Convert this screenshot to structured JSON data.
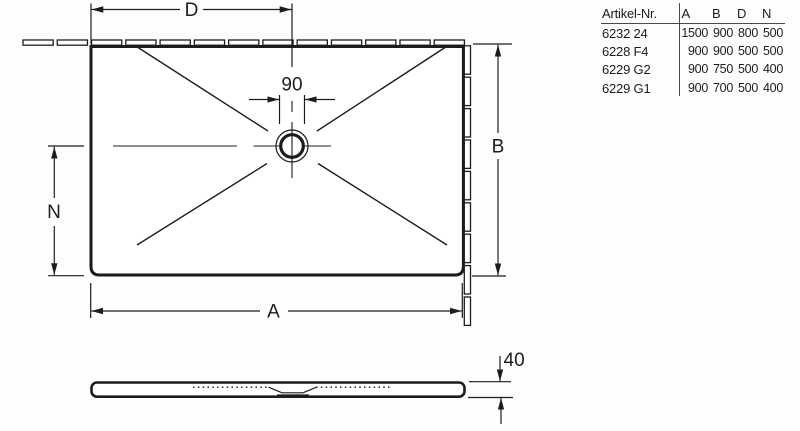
{
  "drawing": {
    "plan": {
      "dim_width_top": "D",
      "dim_drain": "90",
      "dim_height_right": "B",
      "dim_drain_offset_left": "N",
      "dim_width_bottom": "A"
    },
    "side": {
      "dim_thickness": "40"
    }
  },
  "table": {
    "artikel_header": "Artikel-Nr.",
    "value_headers": [
      "A",
      "B",
      "D",
      "N"
    ],
    "rows": [
      {
        "artikel": "6232 24",
        "values": [
          "1500",
          "900",
          "800",
          "500"
        ]
      },
      {
        "artikel": "6228 F4",
        "values": [
          "900",
          "900",
          "500",
          "500"
        ]
      },
      {
        "artikel": "6229 G2",
        "values": [
          "900",
          "750",
          "500",
          "400"
        ]
      },
      {
        "artikel": "6229 G1",
        "values": [
          "900",
          "700",
          "500",
          "400"
        ]
      }
    ]
  },
  "colors": {
    "line": "#1c1c1c",
    "table_rule": "#4a4a4a",
    "background": "#fdfdfd"
  }
}
